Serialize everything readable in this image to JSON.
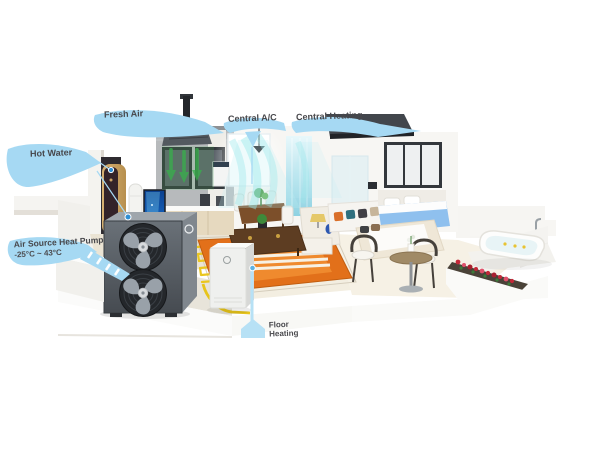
{
  "labels": {
    "fresh_air": "Fresh Air",
    "central_ac": "Central A/C",
    "central_heating": "Central Heating",
    "hot_water": "Hot Water",
    "heat_pump_line1": "Air Source Heat Pump",
    "heat_pump_line2": "-25°C ~ 43°C",
    "floor_heating_line1": "Floor",
    "floor_heating_line2": "Heating"
  },
  "colors": {
    "label_ribbon_blue": "#a6d9f3",
    "label_text": "#47474b",
    "leader_line": "#a6d9f3",
    "marker_dot": "#2f8fd4",
    "fresh_air_arrow_green": "#3ab04c",
    "ac_airflow_cyan": "#9ae8ec",
    "pipe_yellow": "#e7c41a",
    "rug_orange": "#e2701a",
    "bed_blue": "#8fc0ee",
    "heat_pump_gray": "#565c63",
    "flower_red": "#c22838"
  }
}
